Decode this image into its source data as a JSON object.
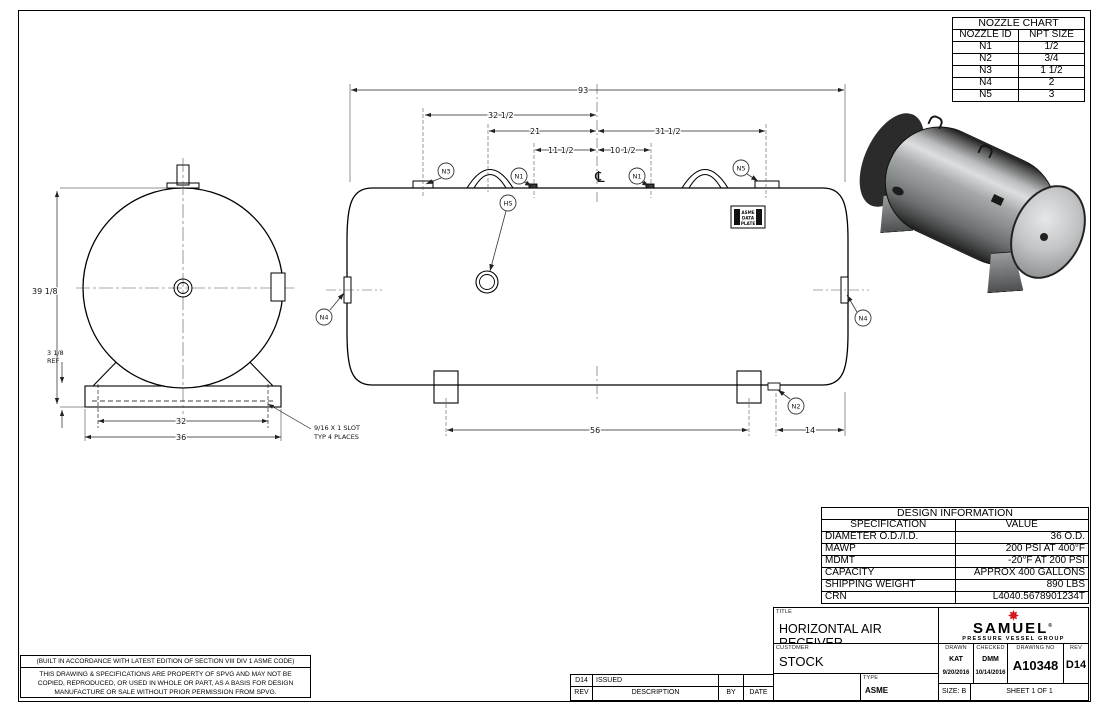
{
  "nozzle_chart": {
    "title": "NOZZLE CHART",
    "col1": "NOZZLE ID",
    "col2": "NPT SIZE",
    "rows": [
      {
        "id": "N1",
        "size": "1/2"
      },
      {
        "id": "N2",
        "size": "3/4"
      },
      {
        "id": "N3",
        "size": "1 1/2"
      },
      {
        "id": "N4",
        "size": "2"
      },
      {
        "id": "N5",
        "size": "3"
      }
    ]
  },
  "design_info": {
    "title": "DESIGN INFORMATION",
    "col1": "SPECIFICATION",
    "col2": "VALUE",
    "rows": [
      {
        "spec": "DIAMETER O.D./I.D.",
        "value": "36 O.D."
      },
      {
        "spec": "MAWP",
        "value": "200 PSI AT 400°F"
      },
      {
        "spec": "MDMT",
        "value": "-20°F AT 200 PSI"
      },
      {
        "spec": "CAPACITY",
        "value": "APPROX 400 GALLONS"
      },
      {
        "spec": "SHIPPING WEIGHT",
        "value": "890 LBS"
      },
      {
        "spec": "CRN",
        "value": "L4040.5678901234T"
      }
    ]
  },
  "title_block": {
    "title_label": "TITLE",
    "title": "HORIZONTAL AIR RECEIVER",
    "customer_label": "CUSTOMER",
    "customer": "STOCK",
    "type_label": "TYPE",
    "type": "ASME",
    "drawn_label": "DRAWN",
    "drawn_by": "KAT",
    "drawn_date": "9/20/2016",
    "checked_label": "CHECKED",
    "checked_by": "DMM",
    "checked_date": "10/14/2016",
    "drawing_no_label": "DRAWING NO",
    "drawing_no": "A10348",
    "rev_label": "REV",
    "rev": "D14",
    "size": "SIZE: B",
    "sheet": "SHEET 1  OF 1",
    "logo_name": "SAMUEL",
    "logo_reg": "®",
    "logo_tagline": "PRESSURE VESSEL GROUP"
  },
  "revision_table": {
    "rev": "D14",
    "description": "ISSUED",
    "by": "",
    "date": "",
    "headers": {
      "rev": "REV",
      "description": "DESCRIPTION",
      "by": "BY",
      "date": "DATE"
    }
  },
  "notes": {
    "code": "(BUILT IN ACCORDANCE WITH LATEST EDITION OF SECTION VIII DIV 1 ASME CODE)",
    "property_1": "THIS DRAWING & SPECIFICATIONS ARE PROPERTY OF SPVG AND MAY NOT BE",
    "property_2": "COPIED, REPRODUCED, OR USED IN WHOLE OR PART, AS A BASIS FOR DESIGN",
    "property_3": "MANUFACTURE OR SALE WITHOUT PRIOR PERMISSION FROM SPVG."
  },
  "dimensions": {
    "overall_length": "93",
    "cl_to_n3": "32 1/2",
    "cl_to_lug": "21",
    "cl_to_n5": "31 1/2",
    "cl_to_n1_left": "11 1/2",
    "cl_to_n1_right": "10 1/2",
    "overall_height": "39 1/8",
    "saddle_height": "3 1/8",
    "saddle_height_ref": "REF",
    "slot_spacing": "32",
    "base_width": "36",
    "saddle_spacing": "56",
    "n2_to_end": "14",
    "slot_note_1": "9/16 X 1 SLOT",
    "slot_note_2": "TYP 4 PLACES"
  },
  "labels": {
    "n1": "N1",
    "n2": "N2",
    "n3": "N3",
    "n4": "N4",
    "n5": "N5",
    "hs": "HS",
    "centerline": "℄",
    "data_plate_1": "ASME",
    "data_plate_2": "DATA",
    "data_plate_3": "PLATE"
  }
}
